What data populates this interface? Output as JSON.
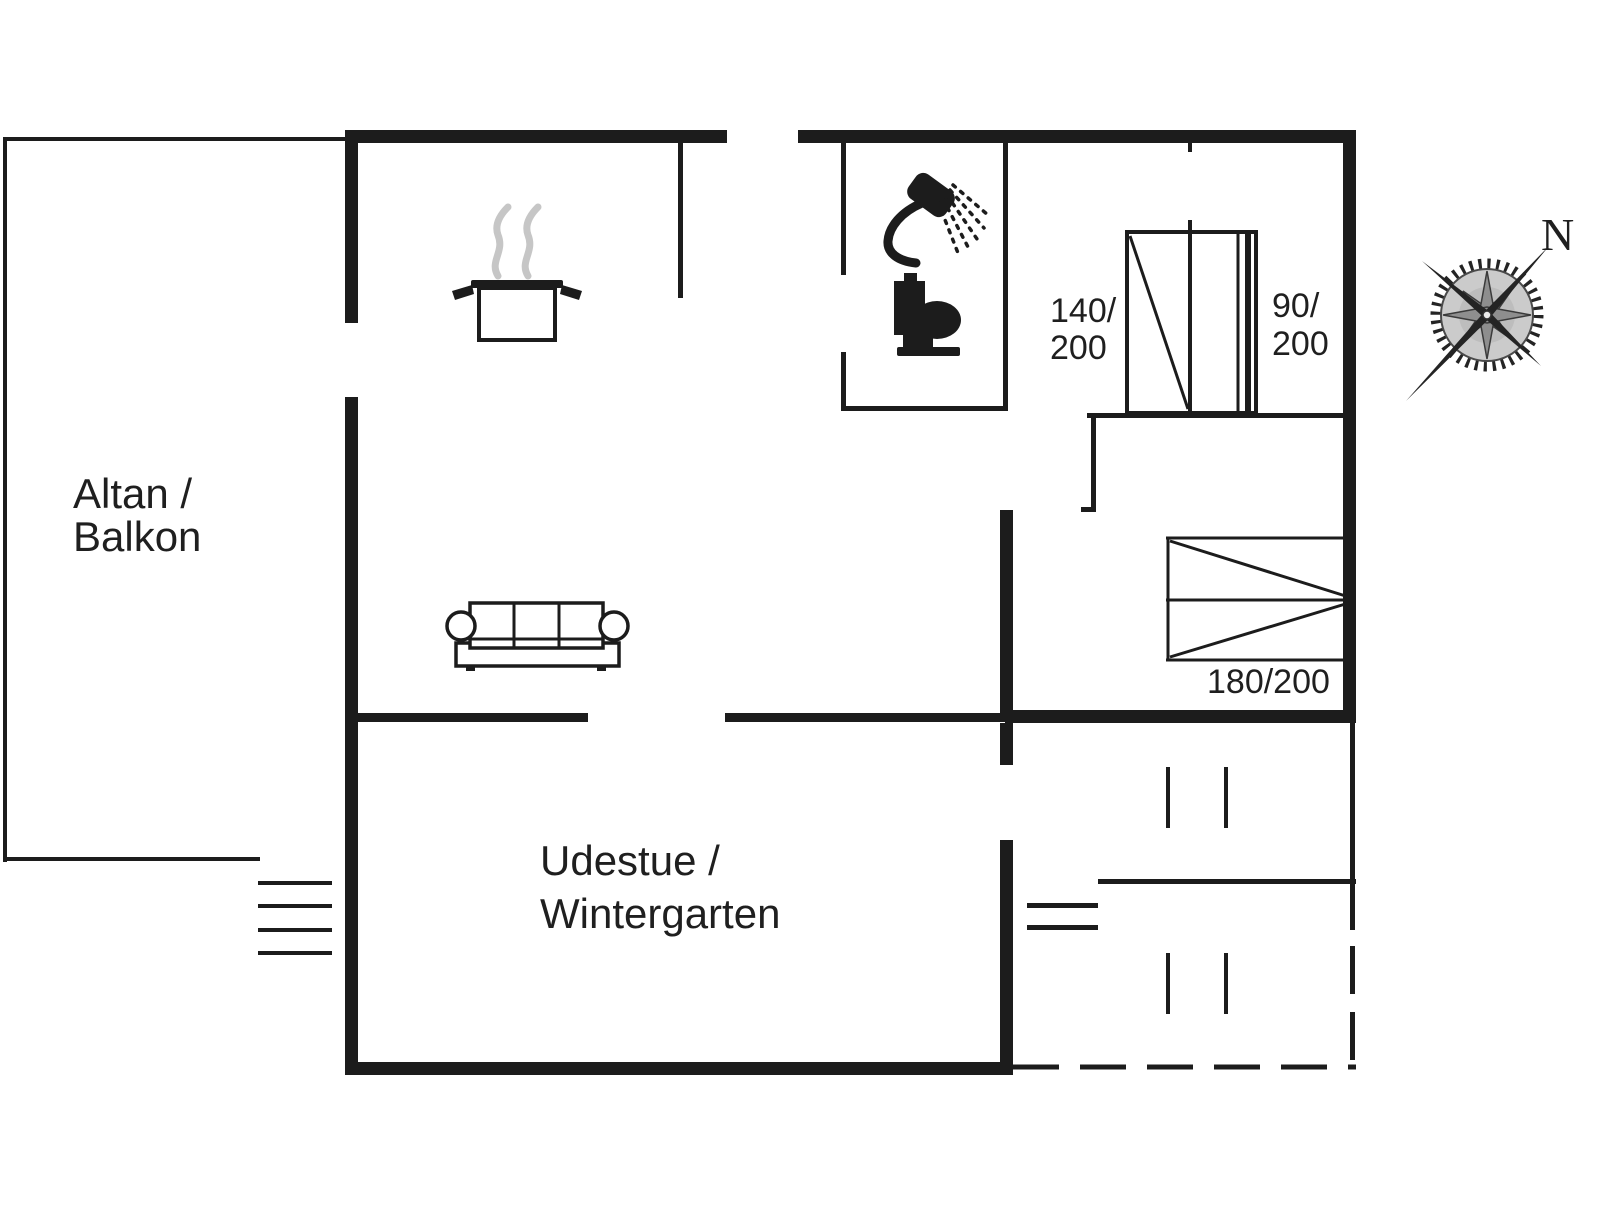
{
  "page": {
    "width": 1606,
    "height": 1205,
    "background": "#ffffff"
  },
  "theme": {
    "wall": "#1c1c1c",
    "text": "#1f1f1f",
    "steam": "#c6c6c6",
    "compass_dark": "#242424",
    "compass_mid": "#8e8e8e",
    "compass_light": "#cbcbcb"
  },
  "rooms": {
    "balcony": {
      "label_line1": "Altan /",
      "label_line2": "Balkon"
    },
    "winter_garden": {
      "label_line1": "Udestue /",
      "label_line2": "Wintergarten"
    }
  },
  "beds": {
    "bed_140": {
      "label_line1": "140/",
      "label_line2": "200"
    },
    "bed_90": {
      "label_line1": "90/",
      "label_line2": "200"
    },
    "bed_180": {
      "label": "180/200"
    }
  },
  "compass": {
    "north_label": "N"
  },
  "icons": {
    "stove": "pot-with-steam-icon",
    "shower": "shower-icon",
    "toilet": "toilet-icon",
    "sofa": "sofa-icon",
    "stairs": "stairs-icon",
    "compass": "compass-rose-icon"
  }
}
